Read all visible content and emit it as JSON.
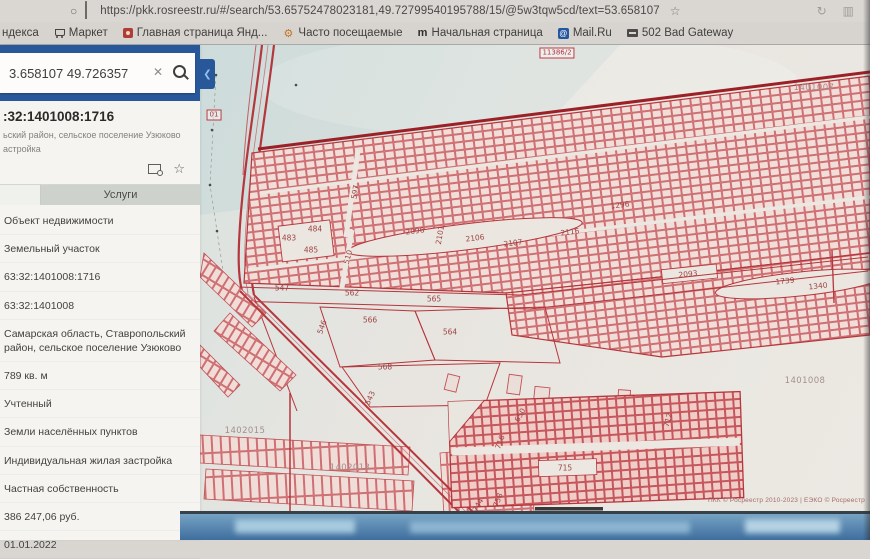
{
  "browser": {
    "url": "https://pkk.rosreestr.ru/#/search/53.65752478023181,49.72799540195788/15/@5w3tqw5cd/text=53.658107",
    "bookmarks": [
      {
        "icon": "none",
        "label": "ндекса"
      },
      {
        "icon": "cart",
        "label": "Маркет"
      },
      {
        "icon": "page-red",
        "label": "Главная страница Янд..."
      },
      {
        "icon": "gear",
        "label": "Часто посещаемые"
      },
      {
        "icon": "letter-m",
        "label": "Начальная страница"
      },
      {
        "icon": "mail",
        "label": "Mail.Ru"
      },
      {
        "icon": "dark-badge",
        "label": "502 Bad Gateway"
      }
    ]
  },
  "sidebar": {
    "search": {
      "value": "3.658107 49.726357"
    },
    "result": {
      "cadastral_number": ":32:1401008:1716",
      "address_line1": "ьский район, сельское поселение Узюково",
      "address_line2": "астройка"
    },
    "tab_services": "Услуги",
    "details": [
      "Объект недвижимости",
      "Земельный участок",
      "63:32:1401008:1716",
      "63:32:1401008",
      "Самарская область, Ставропольский район, сельское поселение Узюково",
      "789 кв. м",
      "Учтенный",
      "Земли населённых пунктов",
      "Индивидуальная жилая застройка",
      "Частная собственность",
      "386 247,06 руб.",
      "01.01.2022"
    ]
  },
  "map": {
    "labels": [
      {
        "text": "11386/2",
        "x": 357,
        "y": 8,
        "cls": "boxed"
      },
      {
        "text": "1401007",
        "x": 614,
        "y": 43,
        "cls": "quarter"
      },
      {
        "text": "01",
        "x": 14,
        "y": 70,
        "cls": "boxed"
      },
      {
        "text": "597",
        "x": 155,
        "y": 147,
        "rot": -80
      },
      {
        "text": "483",
        "x": 89,
        "y": 193
      },
      {
        "text": "484",
        "x": 115,
        "y": 184
      },
      {
        "text": "485",
        "x": 111,
        "y": 205
      },
      {
        "text": "510",
        "x": 148,
        "y": 212,
        "rot": -75
      },
      {
        "text": "2096",
        "x": 215,
        "y": 186,
        "rot": -7
      },
      {
        "text": "2101",
        "x": 240,
        "y": 190,
        "rot": -80
      },
      {
        "text": "2106",
        "x": 275,
        "y": 193,
        "rot": -7
      },
      {
        "text": "2107",
        "x": 313,
        "y": 198,
        "rot": -7
      },
      {
        "text": "2116",
        "x": 370,
        "y": 187,
        "rot": -7
      },
      {
        "text": "1296",
        "x": 420,
        "y": 160,
        "rot": -7
      },
      {
        "text": "2093",
        "x": 488,
        "y": 229,
        "rot": -6
      },
      {
        "text": "1739",
        "x": 585,
        "y": 236,
        "rot": -6
      },
      {
        "text": "1340",
        "x": 618,
        "y": 241,
        "rot": -6
      },
      {
        "text": "547",
        "x": 82,
        "y": 243
      },
      {
        "text": "562",
        "x": 152,
        "y": 248
      },
      {
        "text": "565",
        "x": 234,
        "y": 254
      },
      {
        "text": "566",
        "x": 170,
        "y": 275
      },
      {
        "text": "546",
        "x": 122,
        "y": 282,
        "rot": -70
      },
      {
        "text": "564",
        "x": 250,
        "y": 287
      },
      {
        "text": "568",
        "x": 185,
        "y": 322
      },
      {
        "text": "543",
        "x": 170,
        "y": 353,
        "rot": -65
      },
      {
        "text": "1402015",
        "x": 45,
        "y": 386,
        "cls": "quarter"
      },
      {
        "text": "1402013",
        "x": 150,
        "y": 423,
        "cls": "quarter"
      },
      {
        "text": "650",
        "x": 320,
        "y": 370,
        "rot": -60
      },
      {
        "text": "712",
        "x": 468,
        "y": 375,
        "rot": -75
      },
      {
        "text": "716",
        "x": 300,
        "y": 397,
        "rot": -70
      },
      {
        "text": "715",
        "x": 365,
        "y": 423
      },
      {
        "text": "744",
        "x": 278,
        "y": 460,
        "rot": -60
      },
      {
        "text": "758",
        "x": 298,
        "y": 455,
        "rot": -70
      },
      {
        "text": "1401008",
        "x": 605,
        "y": 336,
        "cls": "quarter"
      }
    ],
    "attribution": "ПКК © Росреестр 2010-2023 | ЕЭКО © Росреестр"
  }
}
